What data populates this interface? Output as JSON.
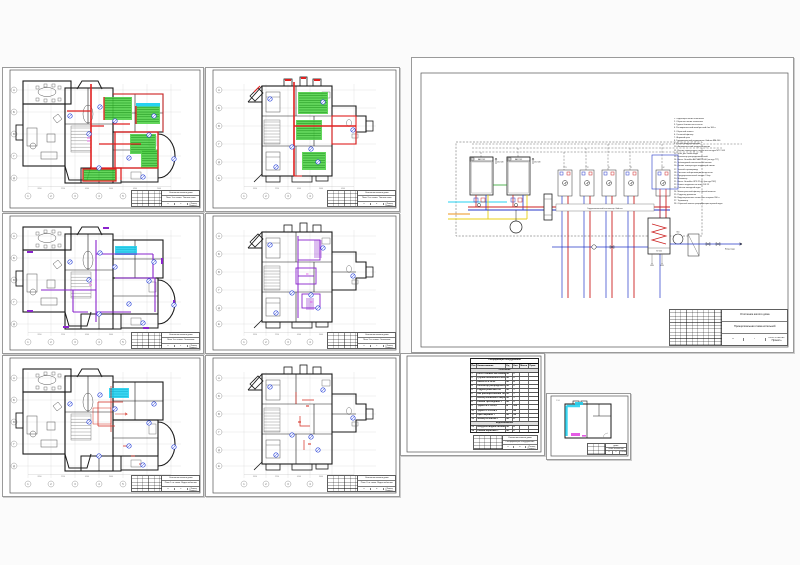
{
  "page": {
    "background": "#fbfbfb"
  },
  "colors": {
    "wall": "#1a1a1a",
    "axis_grid": "#d6d6d6",
    "underfloor_pipe_red": "#e02020",
    "radiator_pipe_purple": "#8a24cc",
    "water_pipe_red": "#d42a1e",
    "zone_green": "#52d24a",
    "zone_coil_green": "#1a8f1a",
    "cold_water_cyan": "#26d2f0",
    "hot_water_magenta": "#e040e0",
    "marker_blue": "#2741d8",
    "gas_yellow": "#e8cf16",
    "gas_orange": "#ee941e",
    "return_blue": "#2437c8"
  },
  "axes": {
    "numbers": [
      "1",
      "2",
      "3",
      "4",
      "5",
      "6",
      "7"
    ],
    "letters": [
      "А",
      "Б",
      "В",
      "Г",
      "Д"
    ],
    "upper_numbers": [
      "1",
      "2",
      "3",
      "4",
      "5",
      "6"
    ],
    "upper_letters": [
      "А",
      "Б",
      "В",
      "Г",
      "Д",
      "Е"
    ],
    "dims": [
      "3950",
      "2250",
      "4500",
      "3000",
      "4300",
      "2400"
    ]
  },
  "sheets": {
    "plan1_floors": {
      "title": "План 1-го этажа. Тёплые полы",
      "sheet": "3"
    },
    "plan2_floors": {
      "title": "План 2-го этажа. Тёплые полы",
      "sheet": "4"
    },
    "plan1_rad": {
      "title": "План 1-го этажа. Отопление",
      "sheet": "1"
    },
    "plan2_rad": {
      "title": "План 2-го этажа. Отопление",
      "sheet": "2"
    },
    "plan1_water": {
      "title": "План 1-го этажа. Водоснабжение",
      "sheet": "5"
    },
    "plan2_water": {
      "title": "План 2-го этажа. Водоснабжение",
      "sheet": "6"
    },
    "schematic": {
      "title": "Принципиальная схема котельной",
      "sheet": "7"
    },
    "specification": {
      "title": "Спецификация оборудования",
      "sheet": "8"
    },
    "boiler_room": {
      "title": "План котельной",
      "sheet": "9"
    }
  },
  "titleblock": {
    "project": "Отопление жилого дома",
    "stage_label": "Стадия",
    "sheet_label": "Лист",
    "sheets_label": "Листов",
    "stage": "П",
    "org": "ООО «Тепло-Проект»"
  },
  "schematic": {
    "boiler_model": "BAXI 24F",
    "boiler_power": "23,8 кВт",
    "separator_label": "Гидравлический коллектор Gidruss",
    "tank_label": "80л",
    "water_inlet_label": "Ввод воды",
    "manifold_labels": [
      "ТП1",
      "ТП2",
      "Р1",
      "Р2",
      "ГВС"
    ],
    "legend_items": [
      "Подающая линия отопления",
      "Обратная линия отопления",
      "Группа безопасности котла",
      "Расширительный мембранный бак 100 л",
      "Обратный клапан",
      "Сетчатый фильтр",
      "Шаровой кран",
      "Гидравлический разделитель Gidruss BM-100",
      "Ручной воздухоотводчик",
      "Автоматический воздухоотводчик",
      "Датчик температуры наружного контура NTC 10К",
      "Кран для слива воды",
      "Коллектор распределительный",
      "Насос Grundfos ALPHA2 25-60 (контур ТП)",
      "Трёхходовой смесительный клапан",
      "Датчик температуры подающей линии",
      "Зонный сервопривод",
      "Система нейтрализации конденсата",
      "Предохранительный клапан 3 бар",
      "Манометр",
      "Насос Grundfos UPS 25-40 (контур ГВС)",
      "Клапан подпитки системы DN 15",
      "Счётчик холодной воды",
      "Магистральный фильтр тонкой очистки",
      "Редуктор давления",
      "Водонагреватель косвенного нагрева 200 л",
      "Термометр",
      "Обратный клапан рециркуляции горячей воды"
    ]
  },
  "spec_table": {
    "title": "Спецификация оборудования",
    "headers": [
      "Поз.",
      "Наименование",
      "Ед.",
      "Кол.",
      "Масса",
      "Прим."
    ],
    "groups": [
      "Отопление",
      "Водоснабжение"
    ],
    "rows": [
      [
        "1",
        "Котёл газовый настенный 24 кВт",
        "шт",
        "2",
        "",
        ""
      ],
      [
        "2",
        "Группа безопасности котла",
        "шт",
        "2",
        "",
        ""
      ],
      [
        "3",
        "Насос UPS 25-60",
        "шт",
        "4",
        "",
        ""
      ],
      [
        "4",
        "Коллектор распределительный",
        "шт",
        "2",
        "",
        ""
      ],
      [
        "5",
        "Гидрострелка BM-100",
        "шт",
        "1",
        "",
        ""
      ],
      [
        "6",
        "Бак расширительный 100 л",
        "шт",
        "1",
        "",
        ""
      ],
      [
        "7",
        "Бойлер косвенного нагрева 200 л",
        "шт",
        "1",
        "",
        ""
      ],
      [
        "8",
        "Клапан трёхходовой 1\"",
        "шт",
        "5",
        "",
        ""
      ],
      [
        "9",
        "Труба PE-X 16×2,0",
        "м",
        "560",
        "",
        ""
      ],
      [
        "10",
        "Труба PP-R 25×4,2",
        "м",
        "84",
        "",
        ""
      ],
      [
        "11",
        "Кран шаровой 1\"",
        "шт",
        "24",
        "",
        ""
      ],
      [
        "12",
        "Фильтр сетчатый 1\"",
        "шт",
        "6",
        "",
        ""
      ],
      [
        "13",
        "Воздухоотводчик автоматич.",
        "шт",
        "8",
        "",
        ""
      ],
      [
        "14",
        "Клапан обратный 1\"",
        "шт",
        "6",
        "",
        ""
      ],
      [
        "15",
        "Радиатор стальной 22-500",
        "шт",
        "18",
        "",
        ""
      ],
      [
        "16",
        "Термоголовка RTR-N",
        "шт",
        "18",
        "",
        ""
      ],
      [
        "17",
        "Коллектор ТП 1\"×8 вых.",
        "шт",
        "2",
        "",
        ""
      ],
      [
        "18",
        "Бак расшир. ГВС 18 л",
        "шт",
        "1",
        "",
        ""
      ],
      [
        "19",
        "Клапан предохр. 6 бар",
        "шт",
        "2",
        "",
        ""
      ],
      [
        "20",
        "Манометр 0–6 бар",
        "шт",
        "4",
        "",
        ""
      ]
    ]
  }
}
